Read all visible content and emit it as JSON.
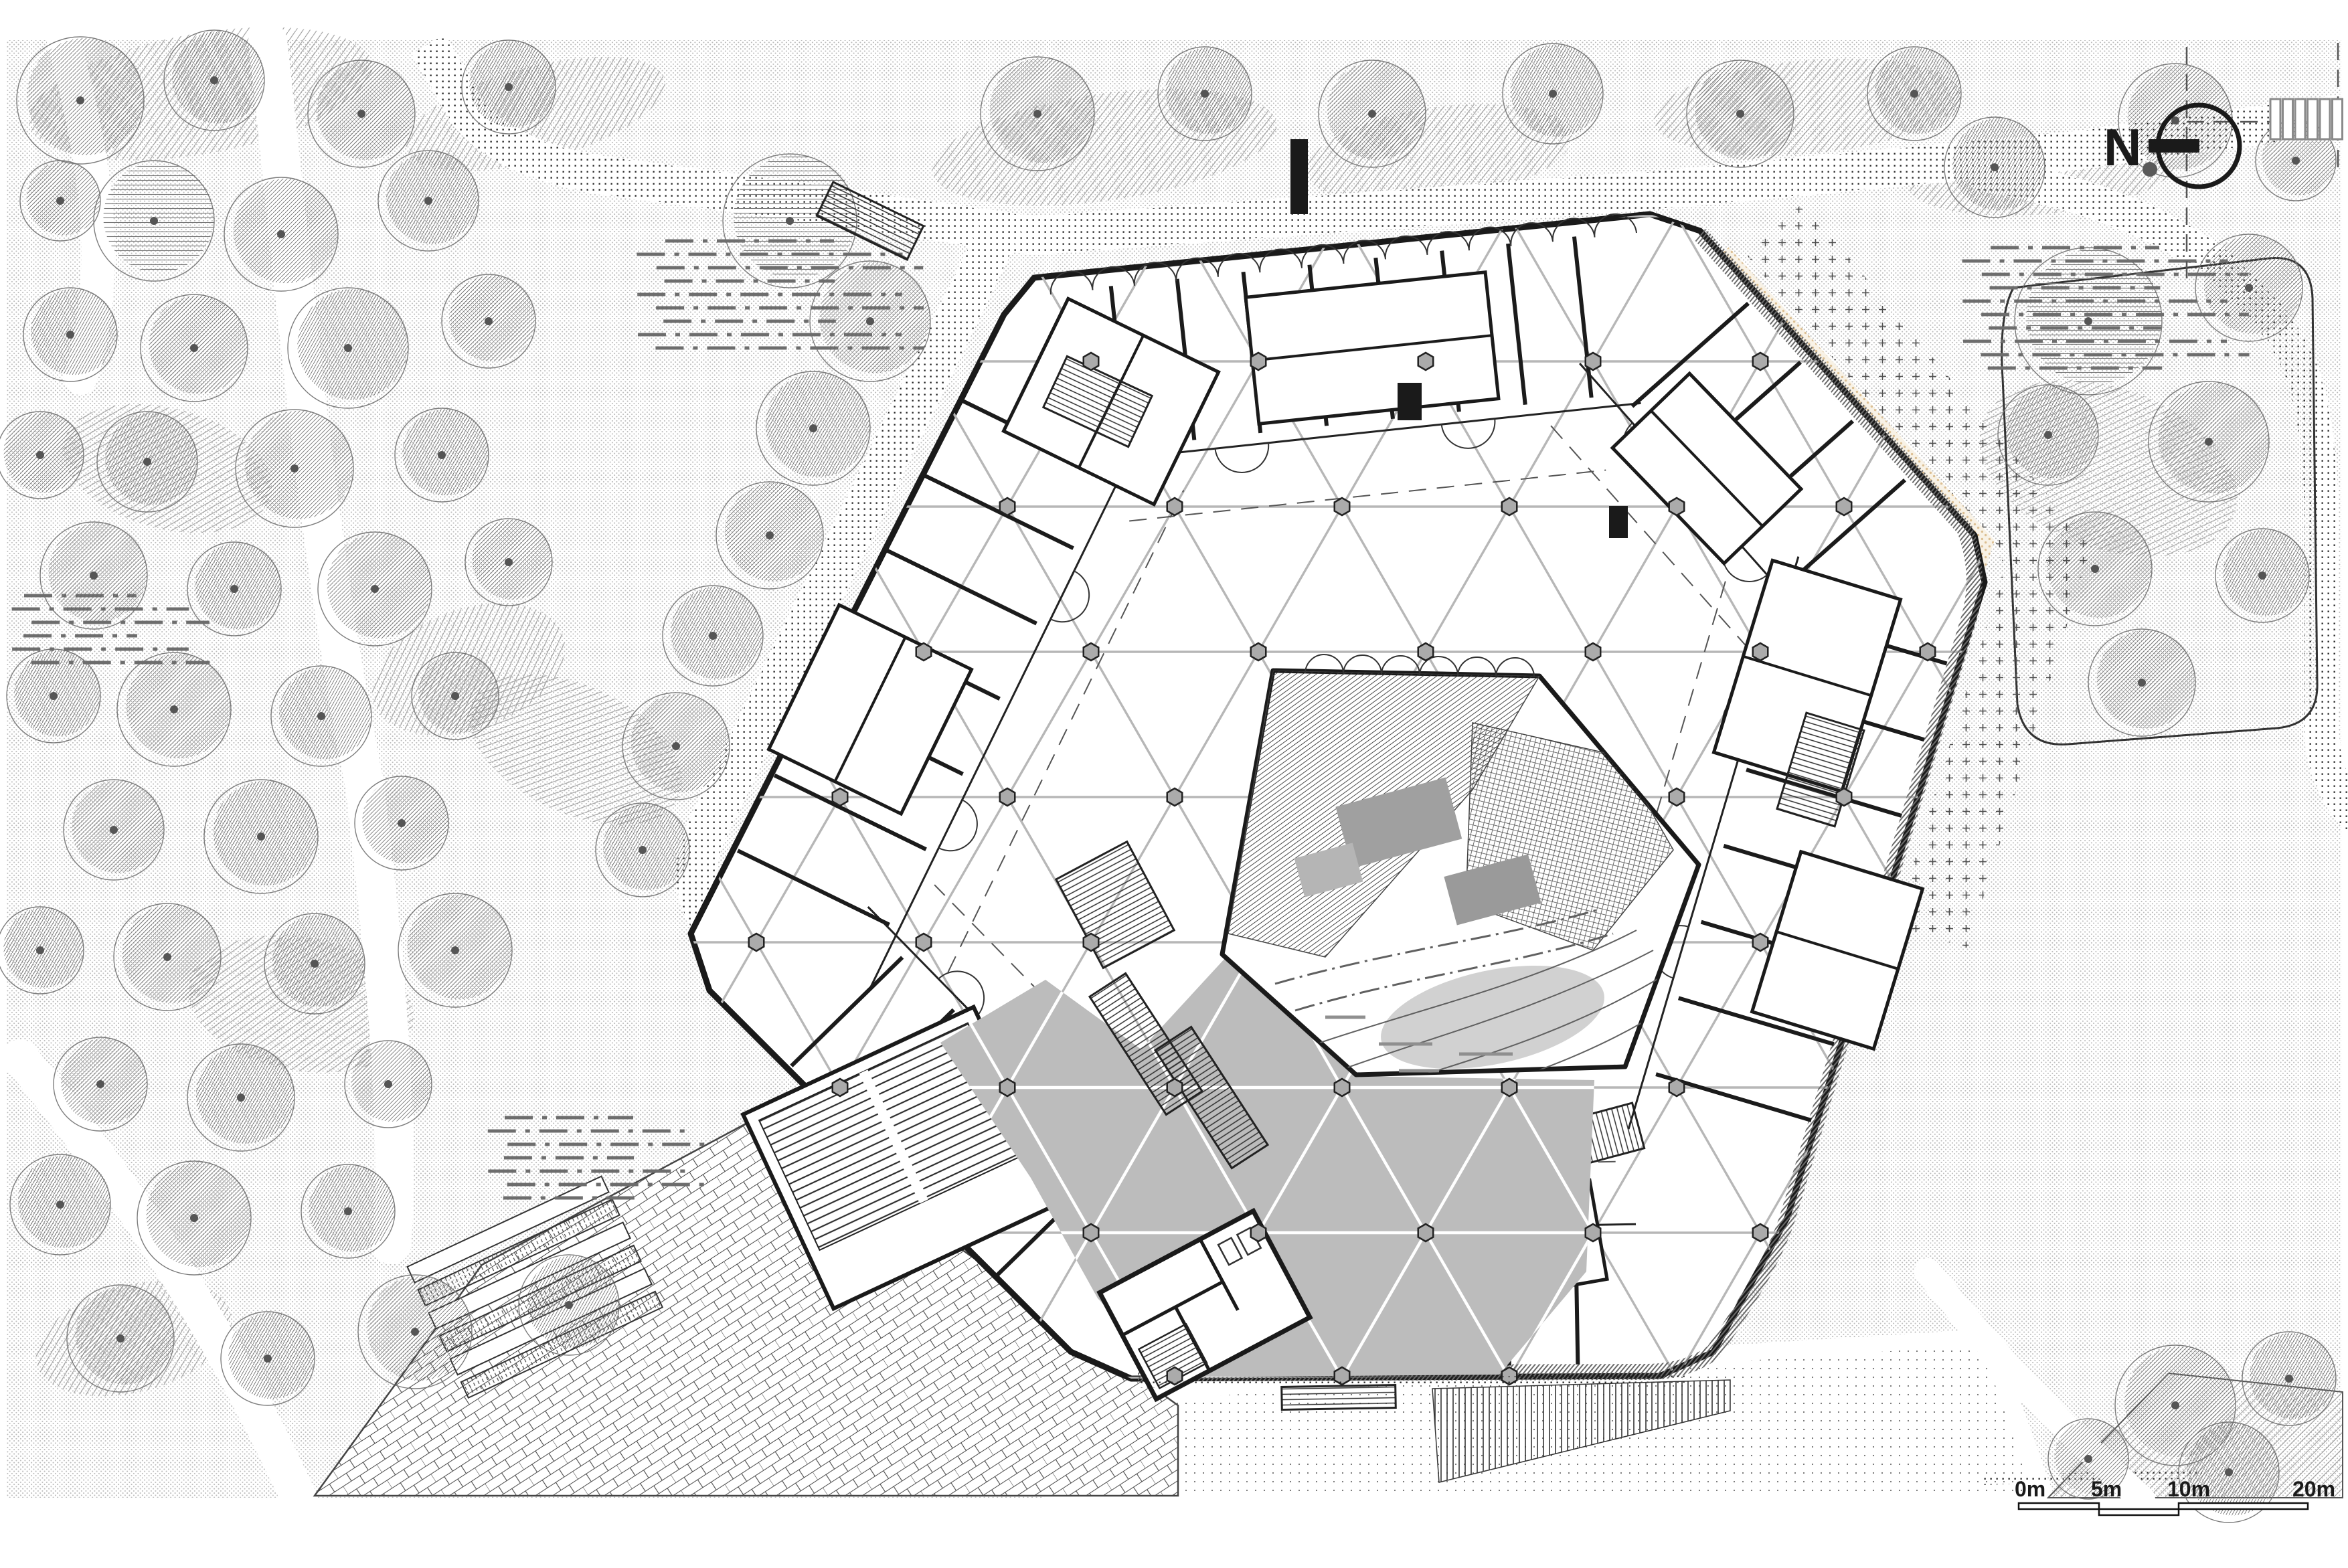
{
  "north": {
    "label": "N"
  },
  "scale_bar": {
    "labels": [
      "0m",
      "5m",
      "10m",
      "20m"
    ]
  },
  "colors": {
    "ink": "#1a1a1a",
    "grid_line": "#b7b7b7",
    "plaza_fill": "#bcbcbc",
    "stipple_dot": "#bdbdbd",
    "road_dot": "#222222",
    "tree_hatch": "#757575",
    "beige_dot": "#dcbf93",
    "facade_hatch": "#6a6a6a",
    "courtyard_patch": "#a0a0a0",
    "contour_line": "#606060"
  }
}
